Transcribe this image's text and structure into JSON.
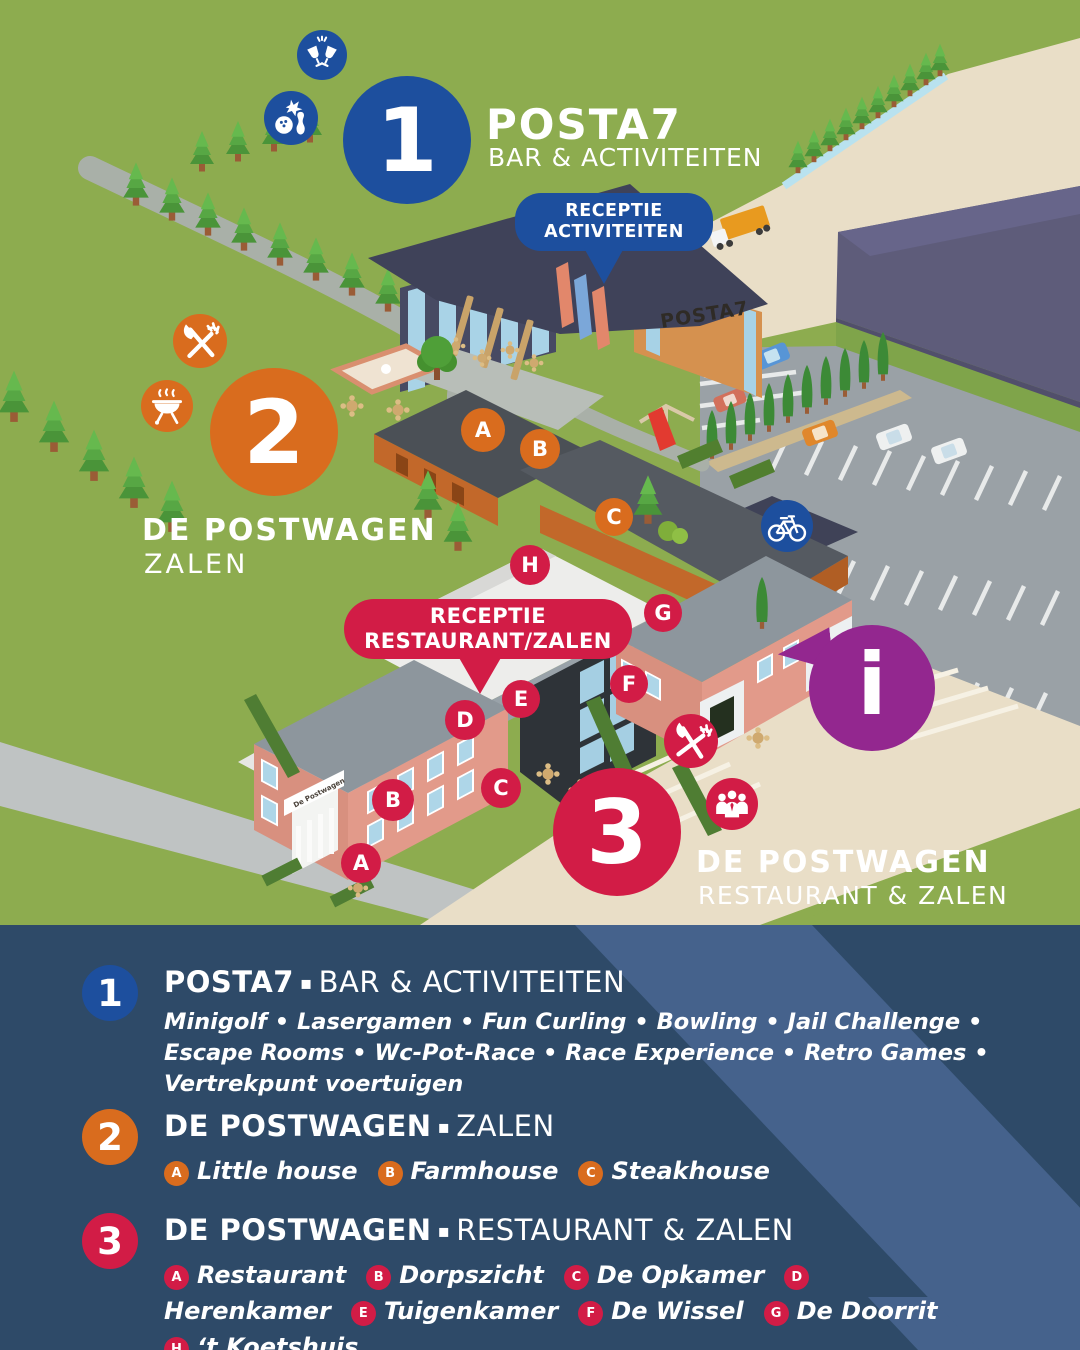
{
  "map": {
    "marker1": {
      "number": "1",
      "title": "POSTA7",
      "subtitle": "BAR & ACTIVITEITEN"
    },
    "marker2": {
      "number": "2",
      "title": "DE POSTWAGEN",
      "subtitle": "ZALEN"
    },
    "marker3": {
      "number": "3",
      "title": "DE POSTWAGEN",
      "subtitle": "RESTAURANT & ZALEN"
    },
    "callouts": {
      "activities": {
        "line1": "RECEPTIE",
        "line2": "ACTIVITEITEN"
      },
      "restaurant": {
        "line1": "RECEPTIE",
        "line2": "RESTAURANT/ZALEN"
      }
    },
    "info_symbol": "i",
    "building_signs": {
      "posta7": "POSTA7",
      "postwagen": "De Postwagen"
    },
    "orange_markers": {
      "a": "A",
      "b": "B",
      "c": "C"
    },
    "red_markers": {
      "a": "A",
      "b": "B",
      "c": "C",
      "d": "D",
      "e": "E",
      "f": "F",
      "g": "G",
      "h": "H"
    },
    "icons": {
      "cheers": "champagne toast",
      "bowling": "bowling ball and pin",
      "dining": "fork and knife",
      "bbq": "barbecue grill",
      "bicycle": "bicycle parking",
      "meeting": "people group",
      "info": "information point"
    }
  },
  "legend": {
    "sections": [
      {
        "number": "1",
        "title": "POSTA7",
        "sep": "▪",
        "subtitle": "BAR & ACTIVITEITEN",
        "description": "Minigolf • Lasergamen • Fun Curling • Bowling • Jail Challenge • Escape Rooms • Wc-Pot-Race • Race Experience • Retro Games • Vertrekpunt voertuigen"
      },
      {
        "number": "2",
        "title": "DE POSTWAGEN",
        "sep": "▪",
        "subtitle": "ZALEN",
        "items": [
          {
            "letter": "A",
            "label": "Little house"
          },
          {
            "letter": "B",
            "label": "Farmhouse"
          },
          {
            "letter": "C",
            "label": "Steakhouse"
          }
        ]
      },
      {
        "number": "3",
        "title": "DE POSTWAGEN",
        "sep": "▪",
        "subtitle": "RESTAURANT & ZALEN",
        "items": [
          {
            "letter": "A",
            "label": "Restaurant"
          },
          {
            "letter": "B",
            "label": "Dorpszicht"
          },
          {
            "letter": "C",
            "label": "De Opkamer"
          },
          {
            "letter": "D",
            "label": "Herenkamer"
          },
          {
            "letter": "E",
            "label": "Tuigenkamer"
          },
          {
            "letter": "F",
            "label": "De Wissel"
          },
          {
            "letter": "G",
            "label": "De Doorrit"
          },
          {
            "letter": "H",
            "label": "‘t Koetshuis"
          }
        ]
      }
    ]
  },
  "colors": {
    "blue": "#1d4f9e",
    "orange": "#d96c1e",
    "red": "#d21c46",
    "purple": "#93278f",
    "panel": "#2e4a68",
    "panel_stripe": "#45628c",
    "grass": "#8dac4f"
  }
}
